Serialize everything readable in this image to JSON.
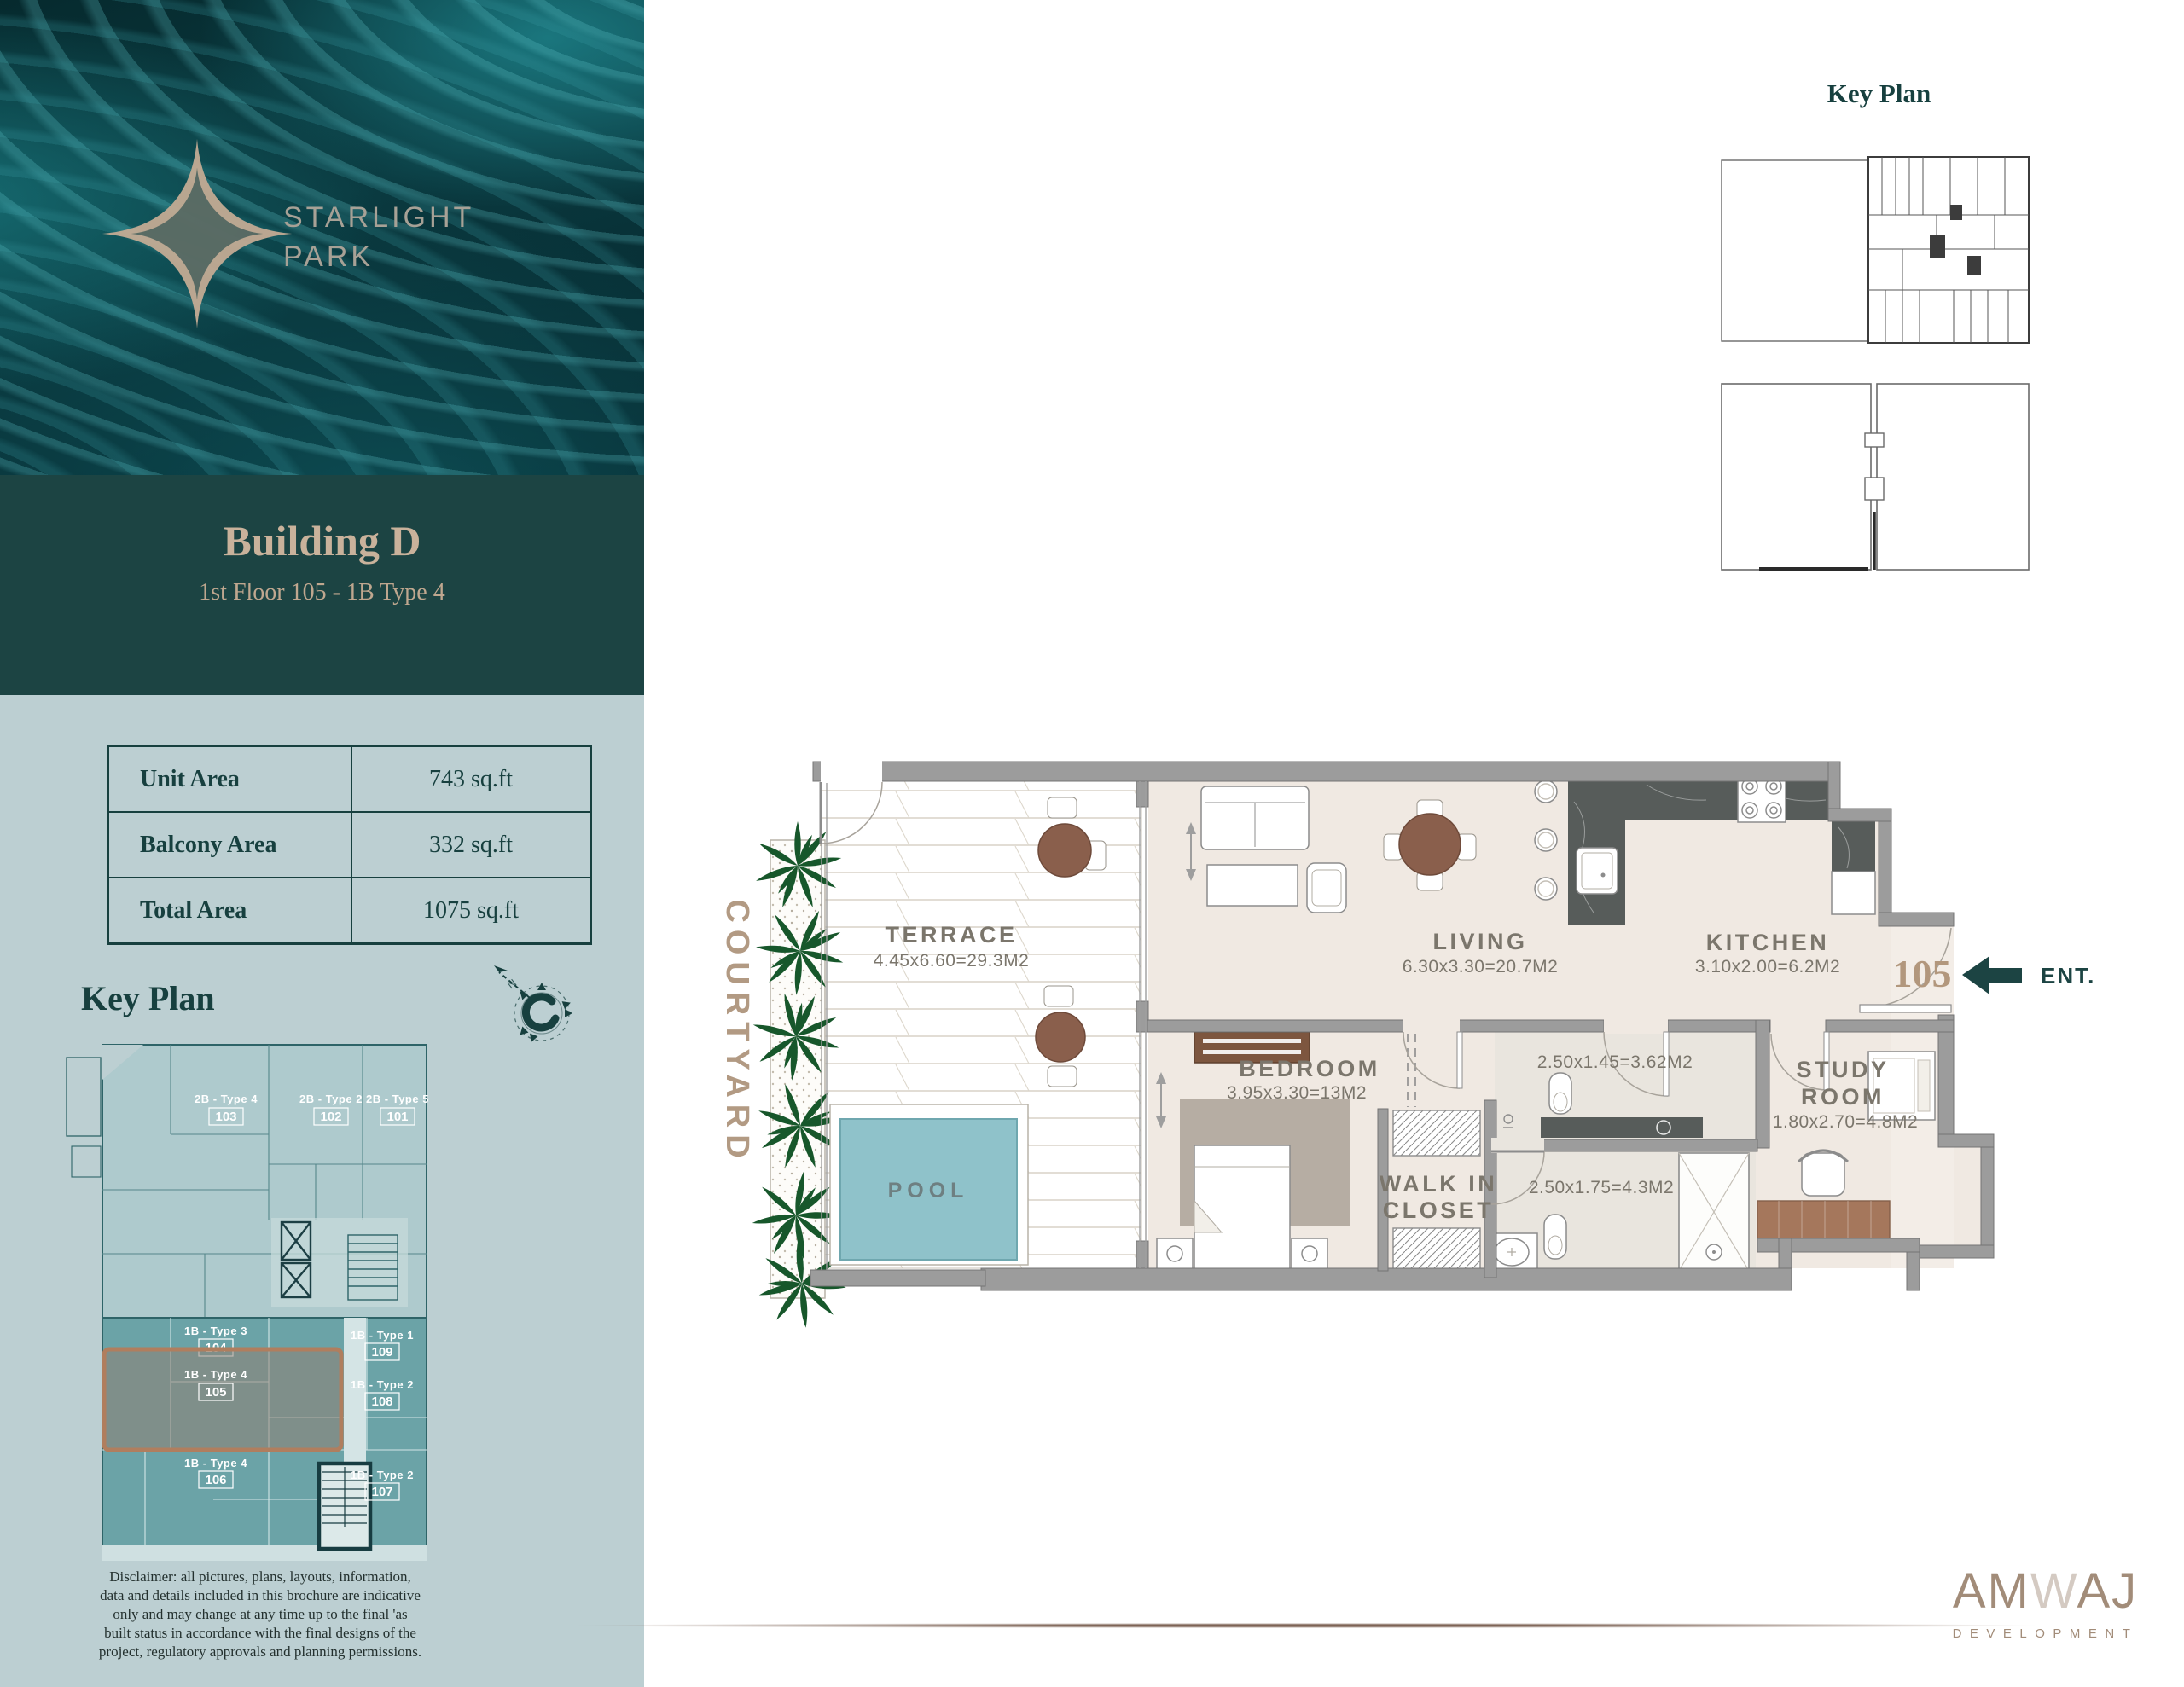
{
  "brand": {
    "line1": "STARLIGHT",
    "line2": "PARK"
  },
  "sidebar": {
    "building_title": "Building D",
    "building_subtitle": "1st Floor 105 - 1B Type 4",
    "area_table": {
      "rows": [
        {
          "label": "Unit Area",
          "value": "743 sq.ft"
        },
        {
          "label": "Balcony Area",
          "value": "332 sq.ft"
        },
        {
          "label": "Total Area",
          "value": "1075 sq.ft"
        }
      ]
    },
    "key_plan_title": "Key Plan",
    "units": [
      {
        "type": "2B - Type 4",
        "num": "103"
      },
      {
        "type": "2B - Type 2",
        "num": "102"
      },
      {
        "type": "2B - Type 5",
        "num": "101"
      },
      {
        "type": "1B - Type 3",
        "num": "104"
      },
      {
        "type": "1B - Type 1",
        "num": "109"
      },
      {
        "type": "1B - Type 4",
        "num": "105"
      },
      {
        "type": "1B - Type 2",
        "num": "108"
      },
      {
        "type": "1B - Type 4",
        "num": "106"
      },
      {
        "type": "1B - Type 2",
        "num": "107"
      }
    ],
    "disclaimer_lines": [
      "Disclaimer: all pictures, plans, layouts, information,",
      "data and details included in this brochure are indicative",
      "only and may change at any time up to the final 'as",
      "built status in accordance with the final designs of the",
      "project, regulatory approvals and planning permissions."
    ]
  },
  "key_plan_panel": {
    "title": "Key Plan"
  },
  "floor_plan": {
    "courtyard_label": "COURTYARD",
    "rooms": {
      "terrace": {
        "name": "TERRACE",
        "dims": "4.45x6.60=29.3M2"
      },
      "living": {
        "name": "LIVING",
        "dims": "6.30x3.30=20.7M2"
      },
      "kitchen": {
        "name": "KITCHEN",
        "dims": "3.10x2.00=6.2M2"
      },
      "bedroom": {
        "name": "BEDROOM",
        "dims": "3.95x3.30=13M2"
      },
      "walk_in_closet": {
        "line1": "WALK IN",
        "line2": "CLOSET"
      },
      "study": {
        "line1": "STUDY",
        "line2": "ROOM",
        "dims": "1.80x2.70=4.8M2"
      },
      "bathroom1": {
        "dims": "2.50x1.45=3.62M2"
      },
      "bathroom2": {
        "dims": "2.50x1.75=4.3M2"
      },
      "pool": {
        "name": "POOL"
      }
    },
    "entry": {
      "unit_number": "105",
      "label": "ENT."
    }
  },
  "footer": {
    "logo_part1": "AM",
    "logo_part2": "W",
    "logo_part3": "AJ",
    "logo_sub": "DEVELOPMENT"
  },
  "colors": {
    "dark_teal": "#1c4443",
    "sidebar_bg": "#bccfd2",
    "cream": "#c9b29b",
    "tan_accent": "#b2977d",
    "wall_gray": "#9c9c9c",
    "pool_teal": "#8fc2ca",
    "plant_green": "#17572b",
    "wood_brown": "#8a5f4c",
    "label_gray": "#7b766c"
  }
}
